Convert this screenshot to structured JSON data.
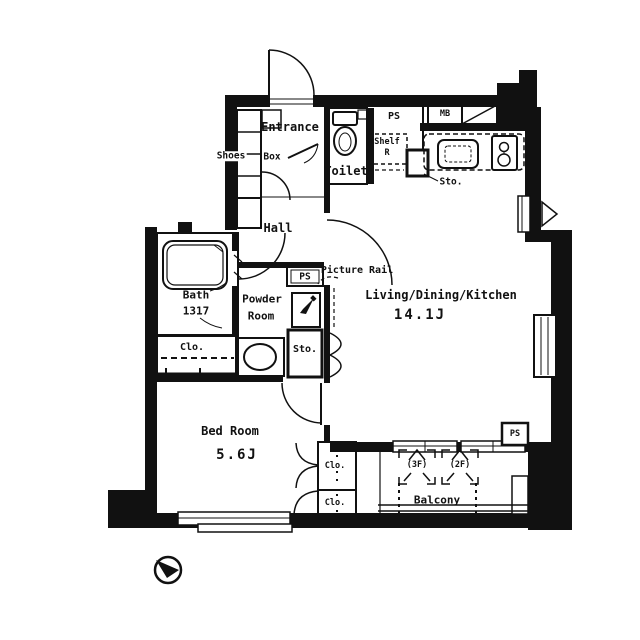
{
  "plan": {
    "rooms": {
      "entrance": {
        "label": "Entrance"
      },
      "shoes_box": {
        "word1": "Shoes",
        "word2": "Box"
      },
      "toilet": {
        "label": "Toilet"
      },
      "hall": {
        "label": "Hall"
      },
      "powder_room": {
        "line1": "Powder",
        "line2": "Room"
      },
      "bath": {
        "label": "Bath",
        "size": "1317"
      },
      "bed_room": {
        "label": "Bed Room",
        "size": "5.6J"
      },
      "ldk": {
        "label": "Living/Dining/Kitchen",
        "size": "14.1J"
      },
      "balcony": {
        "label": "Balcony"
      }
    },
    "features": {
      "ps_top": "PS",
      "ps_mid": "PS",
      "ps_bottom": "PS",
      "shelf_line1": "Shelf",
      "shelf_line2": "R",
      "meter_box": "MB",
      "sto_upper": "Sto.",
      "sto_mid": "Sto.",
      "clo_bath": "Clo.",
      "clo_bed_upper": "Clo.",
      "clo_bed_lower": "Clo.",
      "picture_rail": "Picture Rail",
      "hatch_3f": "(3F)",
      "hatch_2f": "(2F)"
    },
    "colors": {
      "wall": "#111111",
      "background": "#ffffff"
    }
  }
}
